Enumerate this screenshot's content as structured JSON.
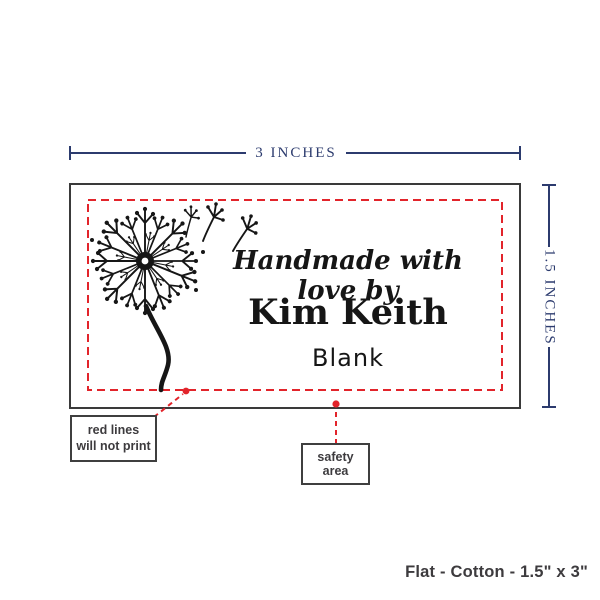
{
  "colors": {
    "navy": "#2c3b6e",
    "red": "#e2242b",
    "outline": "#3a3a3a",
    "ink": "#161616",
    "gray_text": "#3d3b3e"
  },
  "dimensions": {
    "width_label": "3 INCHES",
    "height_label": "1.5 INCHES"
  },
  "label": {
    "script_line": "Handmade with love by",
    "name_line": "Kim Keith",
    "third_line": "Blank"
  },
  "callouts": {
    "red_lines_line1": "red lines",
    "red_lines_line2": "will not print",
    "safety_area": "safety area"
  },
  "footer": {
    "product_info": "Flat - Cotton - 1.5\" x 3\""
  }
}
